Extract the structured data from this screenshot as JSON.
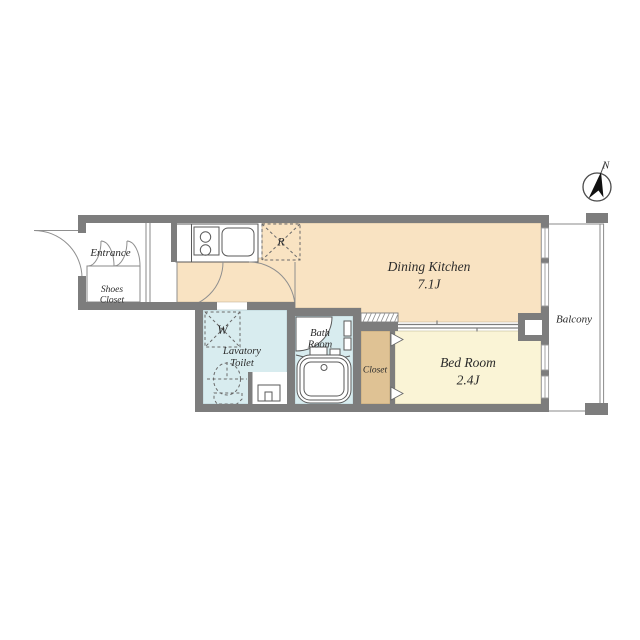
{
  "compass": {
    "label": "N"
  },
  "rooms": {
    "entrance": {
      "label": "Entrance"
    },
    "shoes_closet": {
      "label_line1": "Shoes",
      "label_line2": "Closet"
    },
    "dining_kitchen": {
      "label": "Dining Kitchen",
      "size": "7.1J"
    },
    "bed_room": {
      "label": "Bed Room",
      "size": "2.4J"
    },
    "lavatory_toilet": {
      "label_line1": "Lavatory",
      "label_line2": "Toilet"
    },
    "bath_room": {
      "label_line1": "Bath",
      "label_line2": "Room"
    },
    "closet": {
      "label": "Closet"
    },
    "balcony": {
      "label": "Balcony"
    }
  },
  "appliances": {
    "refrigerator_label": "R",
    "washer_label": "W"
  },
  "colors": {
    "wall": "#7d7d7d",
    "dining_kitchen_floor": "#f9e3c2",
    "bed_room_floor": "#faf4d6",
    "closet_floor": "#dfc294",
    "wet_area_floor": "#d8ecef",
    "outline": "#5a5a5a",
    "text": "#2b2b2b"
  }
}
